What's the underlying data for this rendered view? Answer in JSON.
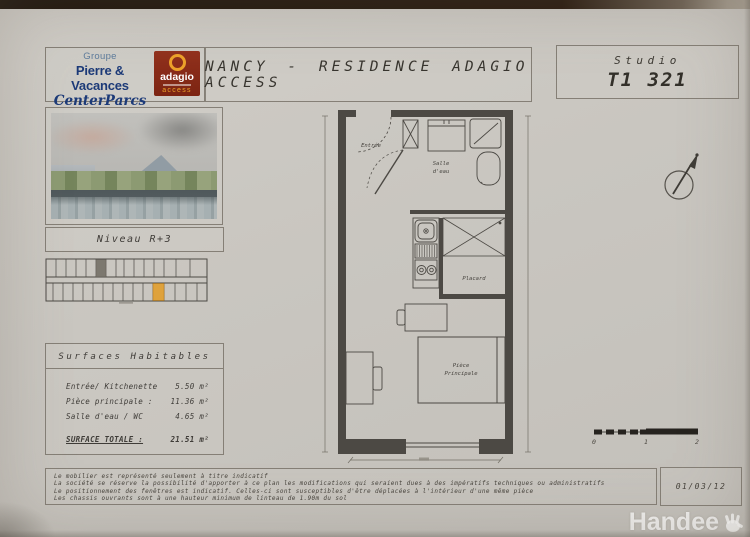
{
  "header": {
    "group": {
      "label": "Groupe",
      "brand_line1": "Pierre & Vacances",
      "brand_line2": "CenterParcs"
    },
    "adagio": {
      "name": "adagio",
      "access": "access",
      "brand_red": "#8c2d1b",
      "brand_orange": "#eda22a"
    },
    "title": "NANCY - RESIDENCE ADAGIO ACCESS",
    "unit": {
      "type": "Studio",
      "number": "T1 321"
    }
  },
  "sidebar": {
    "level_label": "Niveau R+3",
    "keyplan": {
      "highlight_color": "#dfa23c"
    },
    "surfaces": {
      "title": "Surfaces Habitables",
      "rows": [
        {
          "label": "Entrée/ Kitchenette",
          "value": "5.50 m²"
        },
        {
          "label": "Pièce principale :",
          "value": "11.36 m²"
        },
        {
          "label": "Salle d'eau / WC",
          "value": "4.65 m²"
        }
      ],
      "total": {
        "label": "SURFACE TOTALE :",
        "value": "21.51 m²"
      }
    }
  },
  "plan": {
    "labels": {
      "entree": "Entrée",
      "salle_deau_line1": "Salle",
      "salle_deau_line2": "d'eau",
      "placard": "Placard",
      "piece_line1": "Pièce",
      "piece_line2": "Principale"
    },
    "scale": {
      "labels": [
        "0",
        "1",
        "2"
      ]
    }
  },
  "footer": {
    "notes": [
      "Le mobilier est représenté seulement à titre indicatif",
      "La société se réserve la possibilité d'apporter à ce plan les modifications qui seraient dues à des impératifs techniques ou administratifs",
      "Le positionnement des fenêtres est indicatif. Celles-ci sont susceptibles d'être déplacées à l'intérieur d'une même pièce",
      "Les chassis ouvrants sont à une hauteur minimum de linteau de 1.90m du sol"
    ],
    "date": "01/03/12"
  },
  "watermark": "Handee"
}
